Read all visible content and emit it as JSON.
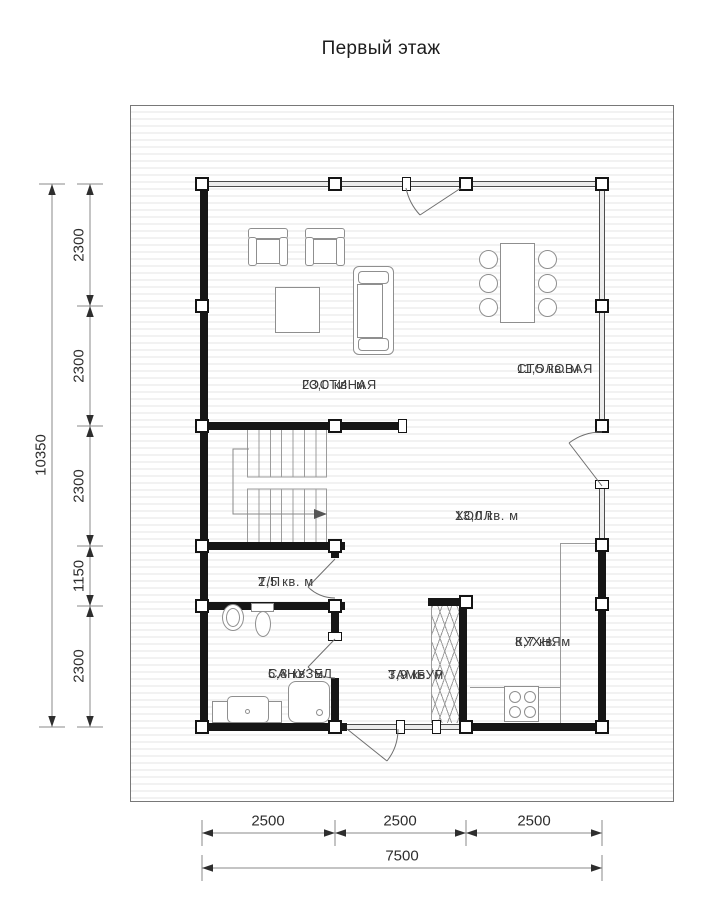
{
  "title": "Первый этаж",
  "rooms": {
    "living": {
      "name": "ГОСТИНАЯ",
      "area": "23,0 кв. м"
    },
    "dining": {
      "name": "СТОЛОВАЯ",
      "area": "11,5 кв. м"
    },
    "hall": {
      "name": "ХОЛЛ",
      "area": "13,0 кв. м"
    },
    "tp": {
      "name": "Т/П",
      "area": "2,5 кв. м"
    },
    "bathroom": {
      "name": "САНУЗЕЛ",
      "area": "5,8 кв. м"
    },
    "tambour": {
      "name": "ТАМБУР",
      "area": "3,9 кв. м"
    },
    "kitchen": {
      "name": "КУХНЯ",
      "area": "8,7 кв. м"
    }
  },
  "dimensions": {
    "left": {
      "segments": [
        "2300",
        "2300",
        "2300",
        "1150",
        "2300"
      ],
      "total": "10350"
    },
    "bottom": {
      "segments": [
        "2500",
        "2500",
        "2500"
      ],
      "total": "7500"
    }
  },
  "colors": {
    "wall": "#161616",
    "thin_line": "#4d4d4d",
    "symbol_line": "#8f8f8f",
    "text": "#3b3b3b"
  }
}
